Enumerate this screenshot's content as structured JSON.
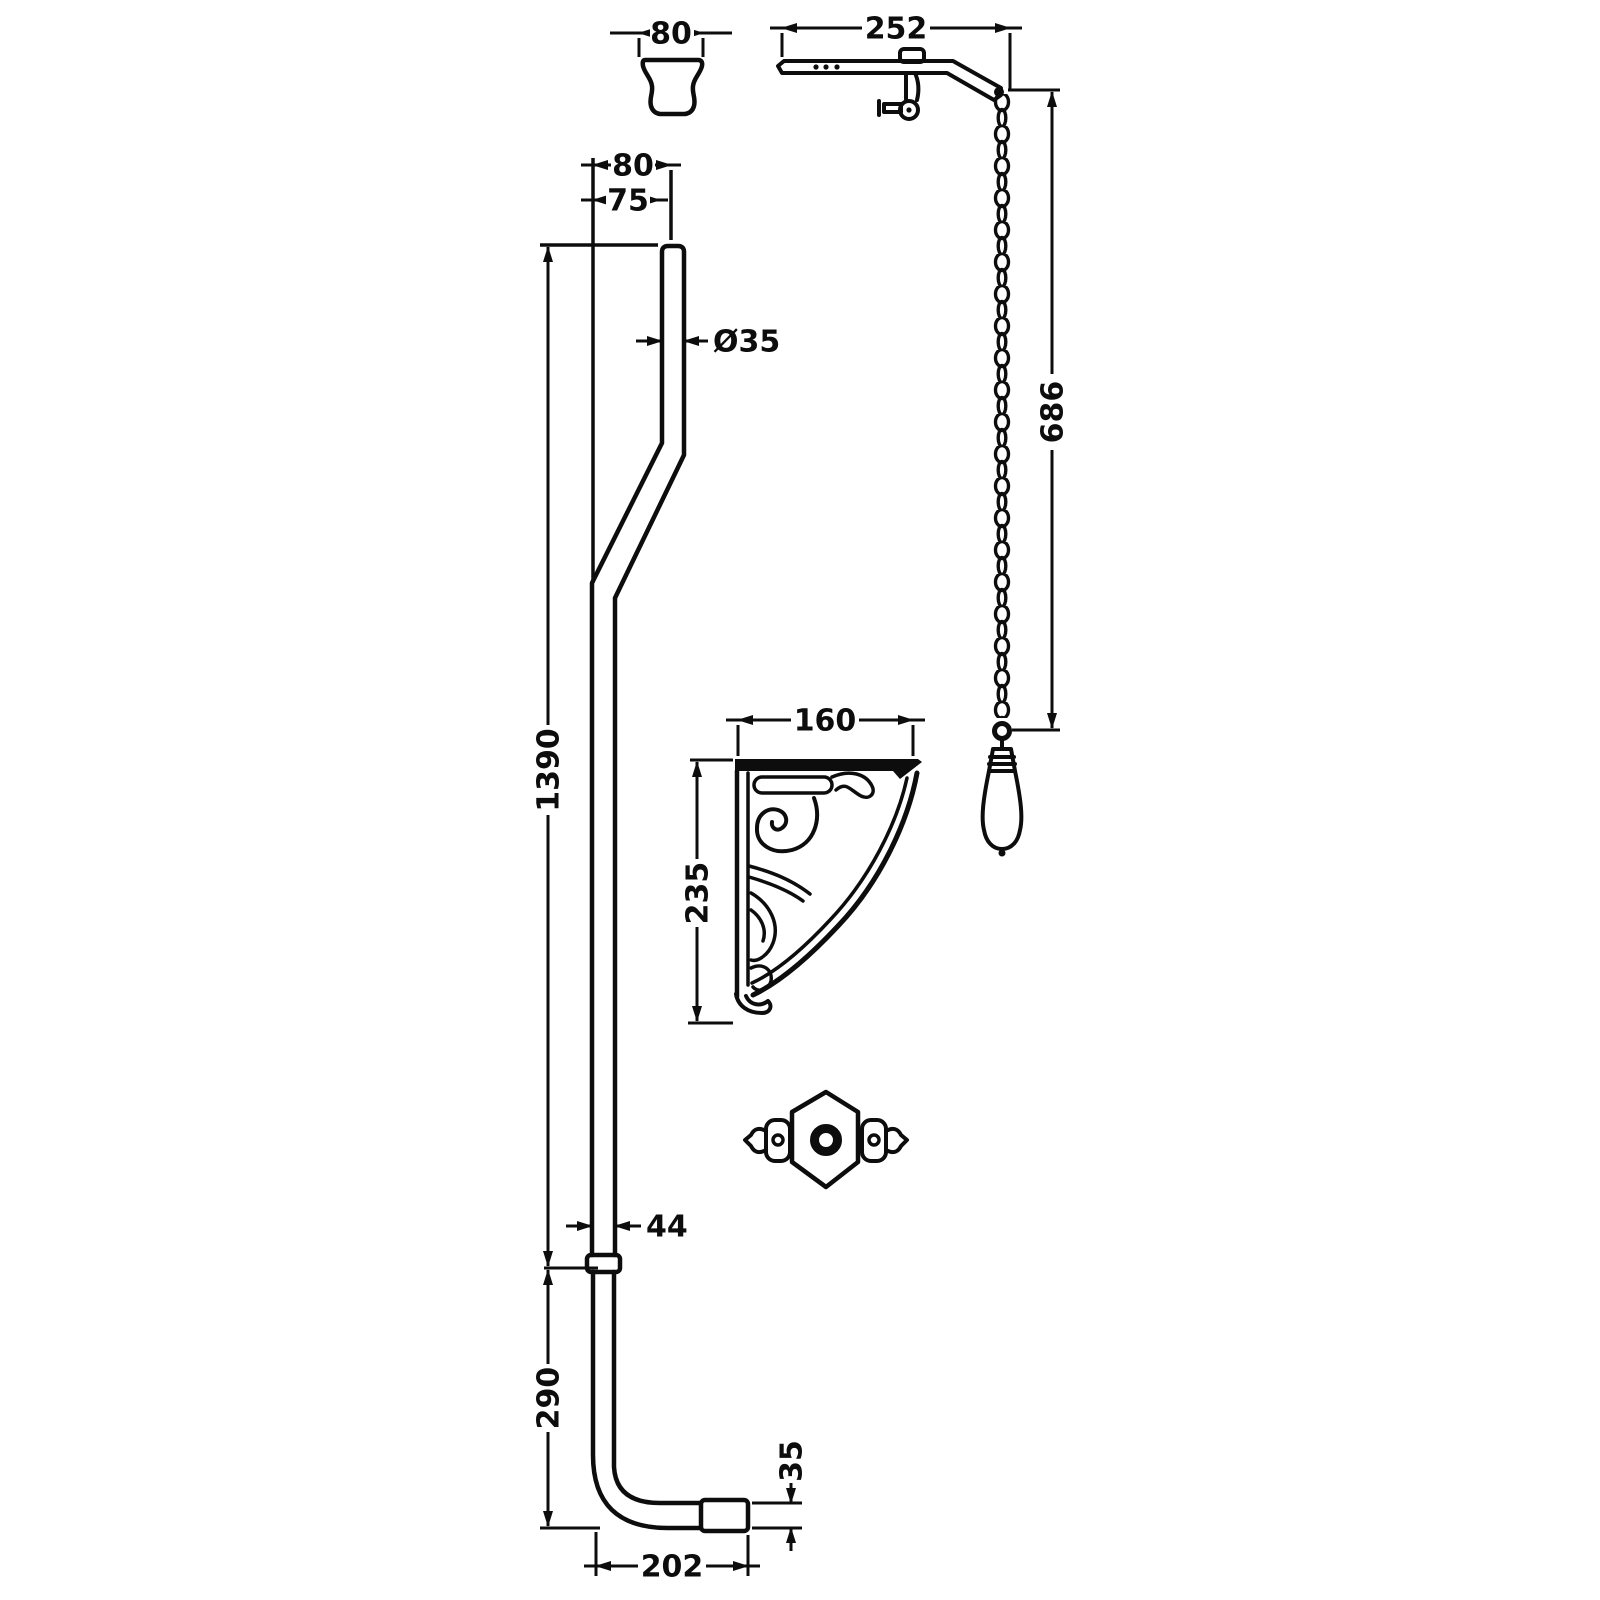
{
  "diagram": {
    "kind": "technical dimension drawing",
    "subject": "high-level cistern flush-pipe kit: lever arm with pull chain and ceramic handle, offset flush pipe, ornate wall bracket, cone connector, escutcheon plate",
    "colors": {
      "line": "#0d0d0d",
      "background": "#ffffff"
    },
    "dims": {
      "cone_width": "80",
      "arm_projection": "252",
      "chain_drop": "686",
      "top_offset_outer": "80",
      "top_offset_inner": "75",
      "pipe_diameter": "Ø35",
      "upper_pipe_length": "1390",
      "bracket_width": "160",
      "bracket_height": "235",
      "joint_diameter": "44",
      "lower_pipe_length": "290",
      "outlet_diameter": "35",
      "outlet_projection": "202"
    },
    "components": {
      "cone": "pan-connector-cone",
      "arm": "cistern-lever-arm",
      "chain": "pull-chain",
      "handle": "ceramic-pull-handle",
      "pipe": "flush-pipe",
      "bracket": "ornate-wall-bracket",
      "escutcheon": "pipe-clip-escutcheon"
    }
  }
}
